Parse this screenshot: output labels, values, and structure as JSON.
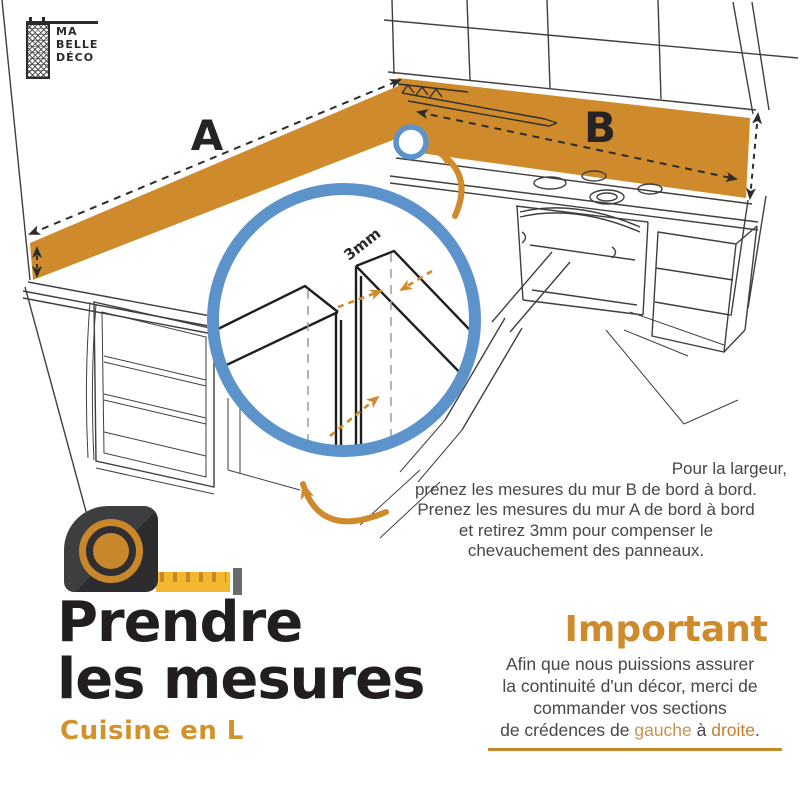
{
  "logo": {
    "line1": "MA",
    "line2": "BELLE",
    "line3": "DÉCO"
  },
  "diagram": {
    "wall_a_label": "A",
    "wall_b_label": "B",
    "overlap_label": "3mm"
  },
  "measure_note": {
    "line1": "Pour la largeur,",
    "line2": "prenez les mesures du mur B de bord à bord.",
    "line3": "Prenez les mesures du mur A de bord à bord",
    "line4": "et retirez 3mm pour compenser le",
    "line5": "chevauchement des panneaux."
  },
  "title": {
    "line1": "Prendre",
    "line2": "les mesures",
    "subtitle": "Cuisine en L"
  },
  "important": {
    "heading": "Important",
    "line1": "Afin que nous puissions assurer",
    "line2": "la continuité d'un décor, merci de",
    "line3": "commander vos sections",
    "line4_prefix": "de crédences de ",
    "word_gauche": "gauche",
    "line4_mid": " à ",
    "word_droite": "droite",
    "line4_suffix": "."
  },
  "colors": {
    "accent_orange": "#CE8A2B",
    "accent_blue": "#5C93CB",
    "tape_yellow": "#F3B82F",
    "text_dark": "#221E1F",
    "text_gray": "#47474A"
  }
}
